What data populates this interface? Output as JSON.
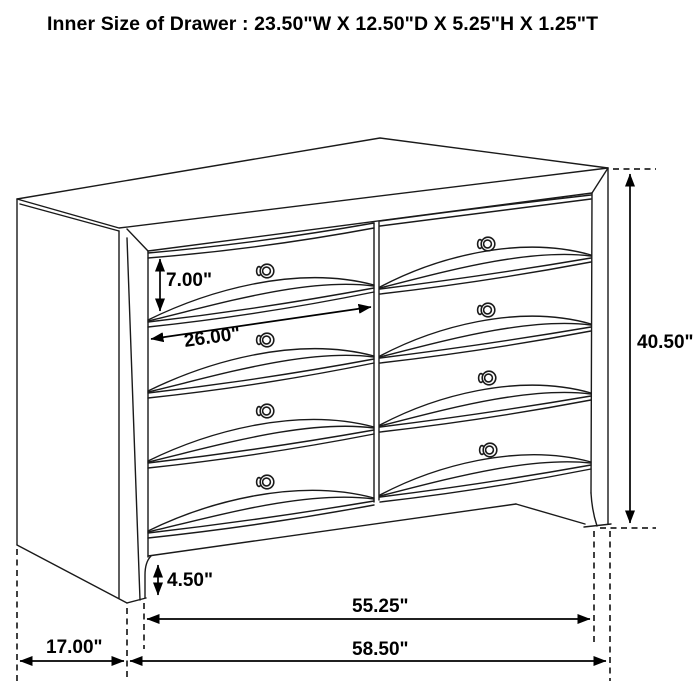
{
  "title": "Inner Size of Drawer : 23.50\"W X 12.50\"D X 5.25\"H X 1.25\"T",
  "diagram": {
    "type": "furniture-dimension-drawing",
    "subject": "dresser with two columns of four drawers (8 drawers, 8 knobs)",
    "background": "#ffffff",
    "line_color": "#1a1a1a",
    "text_color": "#000000",
    "dimensions": {
      "drawer_front_height": "7.00\"",
      "drawer_front_width": "26.00\"",
      "overall_height": "40.50\"",
      "foot_clearance": "4.50\"",
      "case_front_width": "55.25\"",
      "overall_width": "58.50\"",
      "side_depth": "17.00\""
    }
  }
}
